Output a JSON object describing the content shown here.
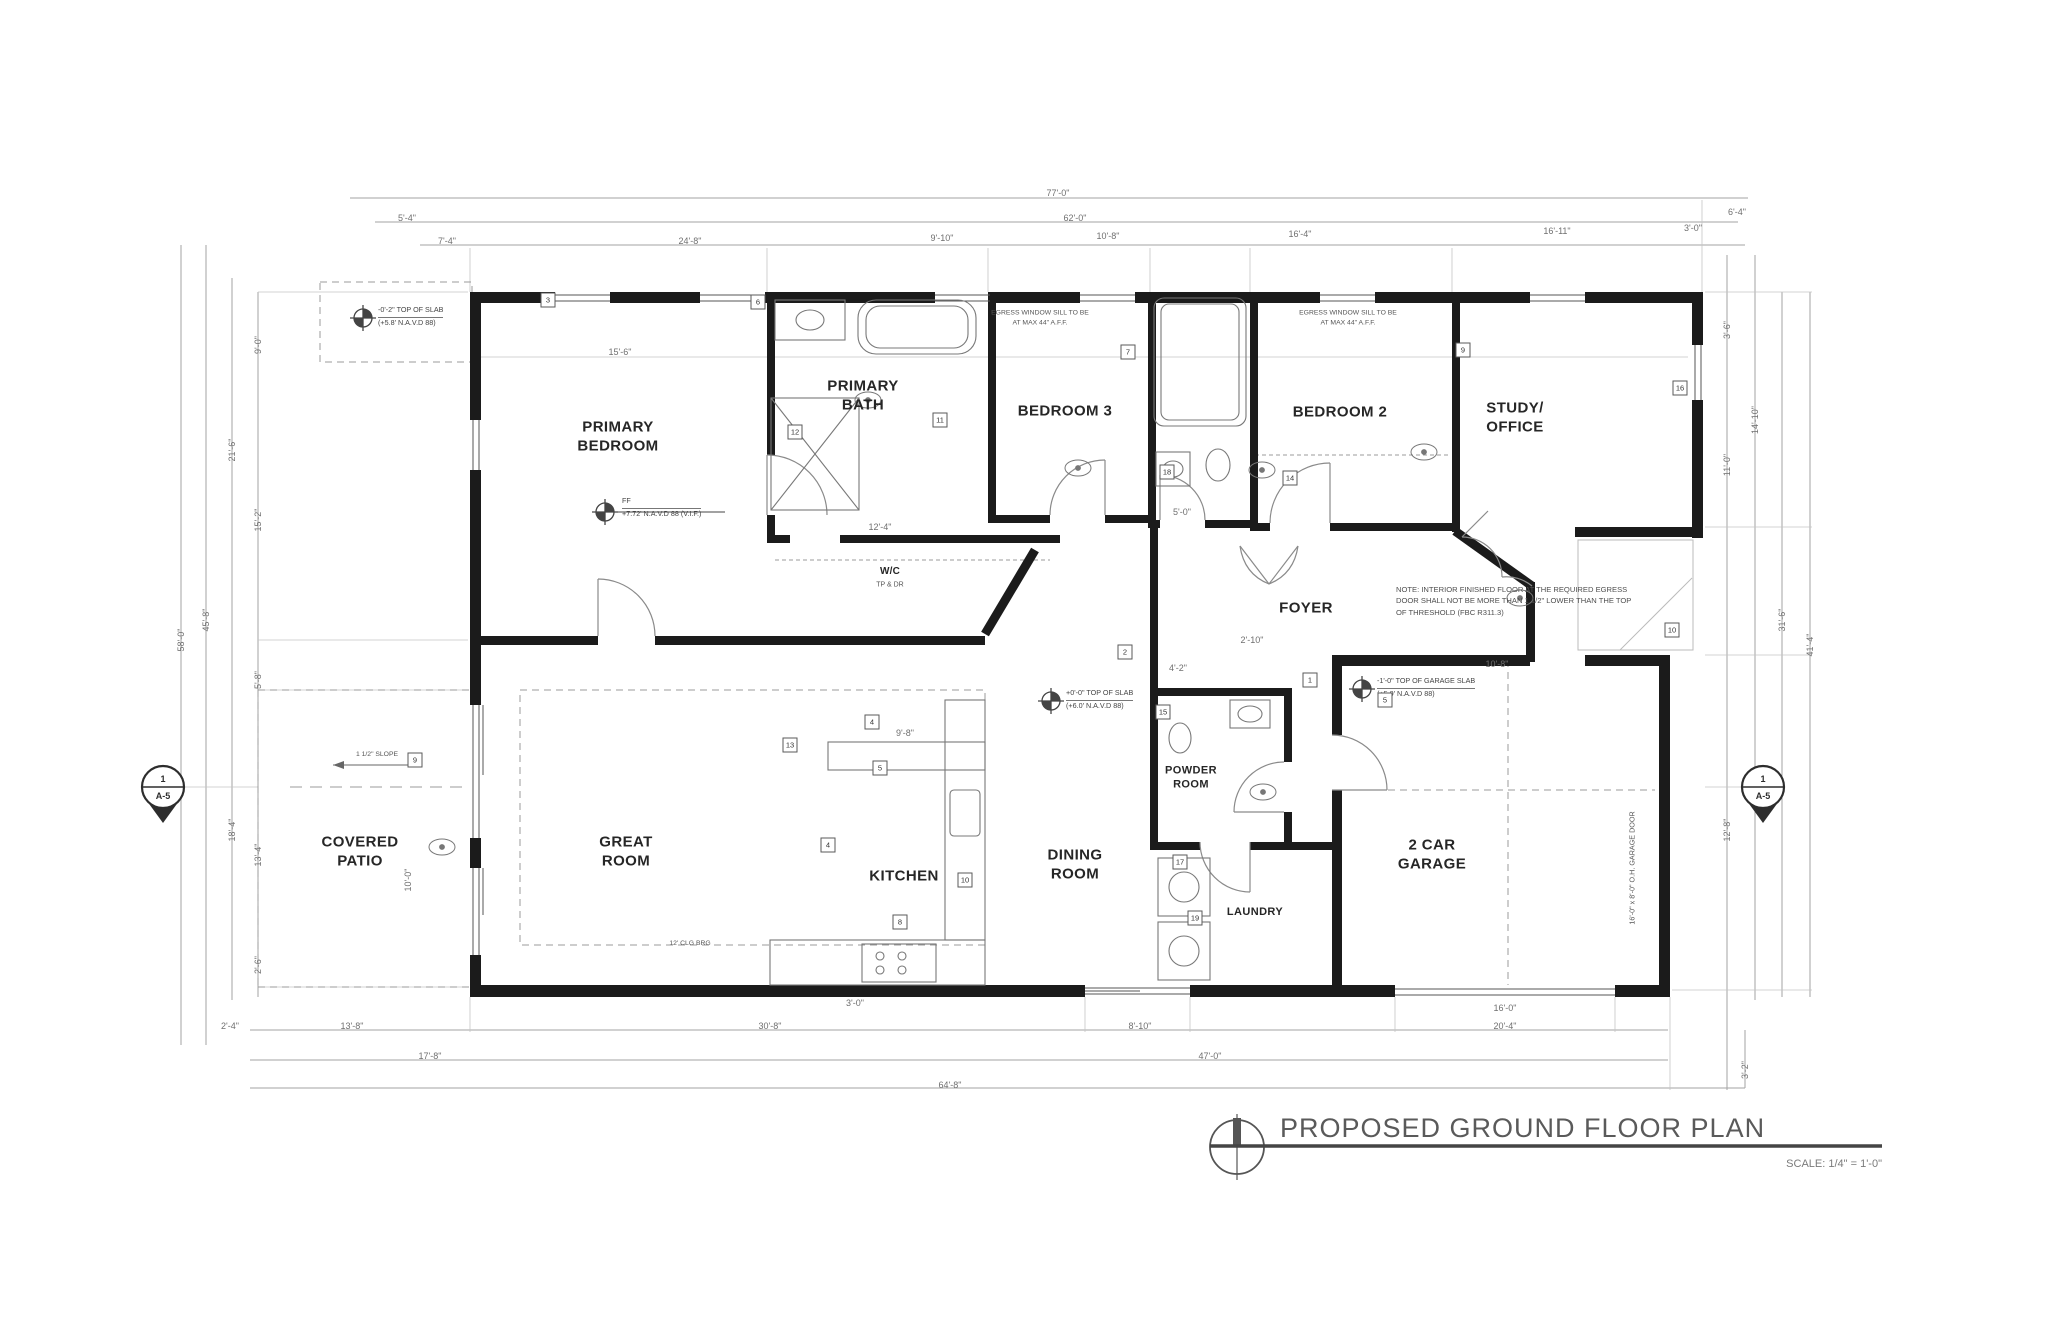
{
  "sheet": {
    "title": "PROPOSED GROUND FLOOR PLAN",
    "scale": "SCALE: 1/4\" = 1'-0\""
  },
  "rooms": {
    "primary_bedroom": "PRIMARY\nBEDROOM",
    "primary_bath": "PRIMARY\nBATH",
    "bedroom3": "BEDROOM 3",
    "bedroom2": "BEDROOM 2",
    "study_office": "STUDY/\nOFFICE",
    "foyer": "FOYER",
    "wic": "W/C",
    "wic_sub": "TP & DR",
    "covered_patio": "COVERED\nPATIO",
    "great_room": "GREAT\nROOM",
    "kitchen": "KITCHEN",
    "dining_room": "DINING\nROOM",
    "powder_room": "POWDER\nROOM",
    "laundry": "LAUNDRY",
    "garage": "2 CAR\nGARAGE"
  },
  "notes": {
    "egress": "EGRESS WINDOW SILL TO BE\nAT MAX 44\" A.F.F.",
    "threshold": "NOTE: INTERIOR FINISHED FLOOR AT THE REQUIRED EGRESS DOOR SHALL NOT BE MORE THAN 1 1/2\" LOWER THAN THE TOP OF THRESHOLD (FBC R311.3)",
    "slope": "1 1/2\" SLOPE",
    "clg": "12' CLG BRG",
    "garage_door": "16'-0\" x 8'-0\" O.H. GARAGE DOOR"
  },
  "markers": {
    "slab_main": {
      "l1": "+0'-0\" TOP OF SLAB",
      "l2": "(+6.0' N.A.V.D 88)"
    },
    "slab_garage": {
      "l1": "-1'-0\" TOP OF GARAGE SLAB",
      "l2": "(+5.0' N.A.V.D 88)"
    },
    "slab_patio": {
      "l1": "-0'-2\" TOP OF SLAB",
      "l2": "(+5.8' N.A.V.D 88)"
    },
    "ff": {
      "l1": "FF",
      "l2": "+7.72' N.A.V.D 88 (V.I.F.)"
    }
  },
  "section_marker": {
    "num": "1",
    "sheet": "A-5"
  },
  "dimensions": [
    {
      "t": "77'-0\"",
      "x": 1058,
      "y": 193
    },
    {
      "t": "5'-4\"",
      "x": 407,
      "y": 218
    },
    {
      "t": "62'-0\"",
      "x": 1075,
      "y": 218
    },
    {
      "t": "6'-4\"",
      "x": 1737,
      "y": 212
    },
    {
      "t": "7'-4\"",
      "x": 447,
      "y": 241
    },
    {
      "t": "24'-8\"",
      "x": 690,
      "y": 241
    },
    {
      "t": "9'-10\"",
      "x": 942,
      "y": 238
    },
    {
      "t": "10'-8\"",
      "x": 1108,
      "y": 236
    },
    {
      "t": "16'-4\"",
      "x": 1300,
      "y": 234
    },
    {
      "t": "16'-11\"",
      "x": 1557,
      "y": 231
    },
    {
      "t": "3'-0\"",
      "x": 1693,
      "y": 228
    },
    {
      "t": "58'-0\"",
      "x": 181,
      "y": 640,
      "r": 1
    },
    {
      "t": "45'-8\"",
      "x": 206,
      "y": 620,
      "r": 1
    },
    {
      "t": "21'-6\"",
      "x": 232,
      "y": 450,
      "r": 1
    },
    {
      "t": "18'-4\"",
      "x": 232,
      "y": 830,
      "r": 1
    },
    {
      "t": "9'-0\"",
      "x": 258,
      "y": 345,
      "r": 1
    },
    {
      "t": "15'-2\"",
      "x": 258,
      "y": 520,
      "r": 1
    },
    {
      "t": "5'-8\"",
      "x": 258,
      "y": 680,
      "r": 1
    },
    {
      "t": "13'-4\"",
      "x": 258,
      "y": 855,
      "r": 1
    },
    {
      "t": "2'-6\"",
      "x": 258,
      "y": 965,
      "r": 1
    },
    {
      "t": "3'-6\"",
      "x": 1727,
      "y": 330,
      "r": 1
    },
    {
      "t": "11'-0\"",
      "x": 1727,
      "y": 465,
      "r": 1
    },
    {
      "t": "14'-10\"",
      "x": 1755,
      "y": 420,
      "r": 1
    },
    {
      "t": "12'-8\"",
      "x": 1727,
      "y": 830,
      "r": 1
    },
    {
      "t": "31'-6\"",
      "x": 1782,
      "y": 620,
      "r": 1
    },
    {
      "t": "41'-4\"",
      "x": 1810,
      "y": 645,
      "r": 1
    },
    {
      "t": "3'-2\"",
      "x": 1745,
      "y": 1070,
      "r": 1
    },
    {
      "t": "2'-4\"",
      "x": 230,
      "y": 1026
    },
    {
      "t": "13'-8\"",
      "x": 352,
      "y": 1026
    },
    {
      "t": "30'-8\"",
      "x": 770,
      "y": 1026
    },
    {
      "t": "8'-10\"",
      "x": 1140,
      "y": 1026
    },
    {
      "t": "20'-4\"",
      "x": 1505,
      "y": 1026
    },
    {
      "t": "17'-8\"",
      "x": 430,
      "y": 1056
    },
    {
      "t": "47'-0\"",
      "x": 1210,
      "y": 1056
    },
    {
      "t": "64'-8\"",
      "x": 950,
      "y": 1085
    },
    {
      "t": "15'-6\"",
      "x": 620,
      "y": 352
    },
    {
      "t": "12'-4\"",
      "x": 880,
      "y": 527
    },
    {
      "t": "5'-0\"",
      "x": 1182,
      "y": 512
    },
    {
      "t": "4'-2\"",
      "x": 1178,
      "y": 668
    },
    {
      "t": "2'-10\"",
      "x": 1252,
      "y": 640
    },
    {
      "t": "10'-8\"",
      "x": 1497,
      "y": 664
    },
    {
      "t": "9'-8\"",
      "x": 905,
      "y": 733
    },
    {
      "t": "3'-0\"",
      "x": 855,
      "y": 1003
    },
    {
      "t": "16'-0\"",
      "x": 1505,
      "y": 1008
    },
    {
      "t": "10'-0\"",
      "x": 408,
      "y": 880,
      "r": 1
    }
  ],
  "keynotes": [
    {
      "n": "3",
      "x": 548,
      "y": 300
    },
    {
      "n": "6",
      "x": 758,
      "y": 302
    },
    {
      "n": "12",
      "x": 795,
      "y": 432
    },
    {
      "n": "11",
      "x": 940,
      "y": 420
    },
    {
      "n": "7",
      "x": 1128,
      "y": 352
    },
    {
      "n": "18",
      "x": 1167,
      "y": 472
    },
    {
      "n": "14",
      "x": 1290,
      "y": 478
    },
    {
      "n": "9",
      "x": 1463,
      "y": 350
    },
    {
      "n": "13",
      "x": 790,
      "y": 745
    },
    {
      "n": "4",
      "x": 872,
      "y": 722
    },
    {
      "n": "5",
      "x": 880,
      "y": 768
    },
    {
      "n": "4",
      "x": 828,
      "y": 845
    },
    {
      "n": "10",
      "x": 965,
      "y": 880
    },
    {
      "n": "8",
      "x": 900,
      "y": 922
    },
    {
      "n": "2",
      "x": 1125,
      "y": 652
    },
    {
      "n": "1",
      "x": 1310,
      "y": 680
    },
    {
      "n": "15",
      "x": 1163,
      "y": 712
    },
    {
      "n": "17",
      "x": 1180,
      "y": 862
    },
    {
      "n": "19",
      "x": 1195,
      "y": 918
    },
    {
      "n": "5",
      "x": 1385,
      "y": 700
    },
    {
      "n": "16",
      "x": 1680,
      "y": 388
    },
    {
      "n": "10",
      "x": 1672,
      "y": 630
    },
    {
      "n": "9",
      "x": 415,
      "y": 760
    }
  ]
}
